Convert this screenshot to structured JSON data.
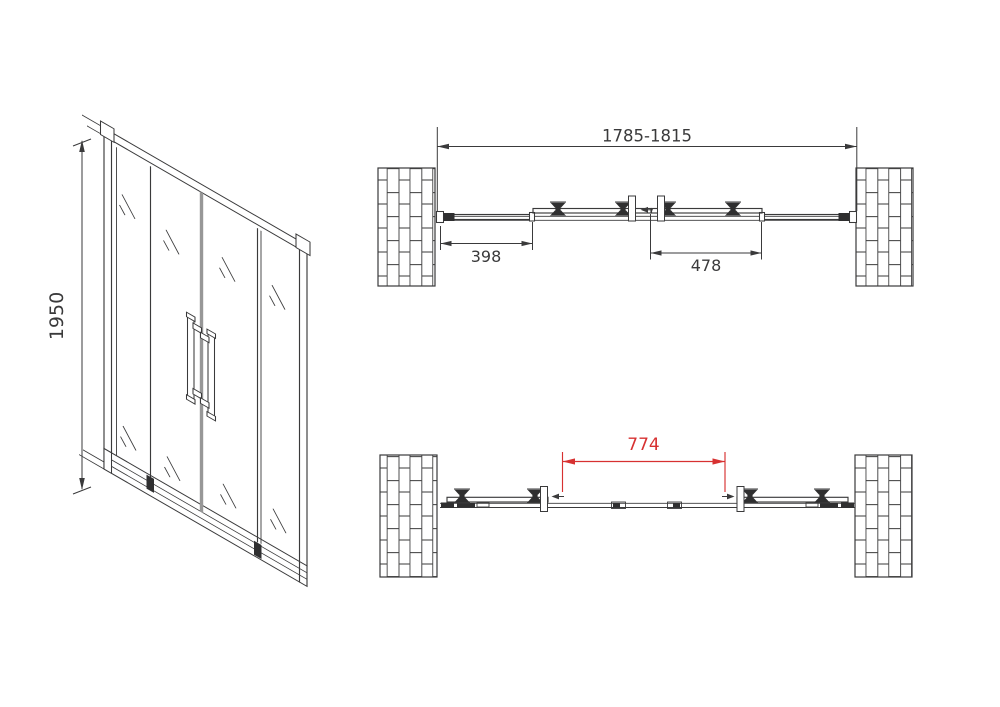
{
  "drawing": {
    "type": "shower-door-technical-drawing",
    "front_view": {
      "height_dim": "1950"
    },
    "top_view": {
      "overall_width_dim": "1785-1815",
      "fixed_panel_dim": "398",
      "sliding_panel_dim": "478"
    },
    "bottom_view": {
      "opening_dim": "774"
    },
    "colors": {
      "line": "#3a3a3b",
      "dimension_red": "#d73131",
      "center_stile_gray": "#979797",
      "background": "#ffffff"
    }
  }
}
